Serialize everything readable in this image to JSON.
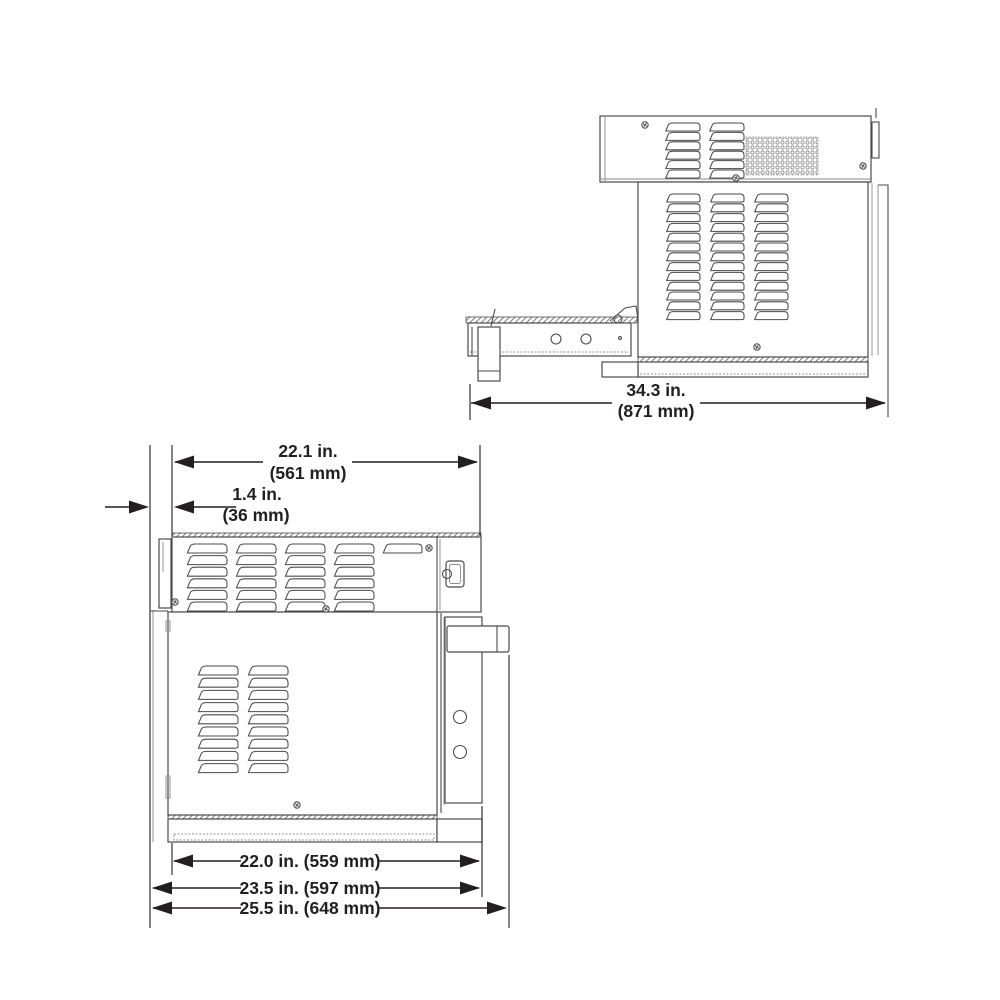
{
  "document": {
    "type": "technical-dimension-drawing",
    "views": [
      "side-view",
      "front-view"
    ]
  },
  "dims": {
    "depth": {
      "in_label": "34.3 in.",
      "mm_label": "(871 mm)"
    },
    "width_top": {
      "in_label": "22.1 in.",
      "mm_label": "(561 mm)"
    },
    "offset": {
      "in_label": "1.4 in.",
      "mm_label": "(36 mm)"
    },
    "width_inner": {
      "label": "22.0 in. (559 mm)"
    },
    "width_mid": {
      "label": "23.5 in. (597 mm)"
    },
    "width_outer": {
      "label": "25.5 in. (648 mm)"
    }
  },
  "colors": {
    "ink": "#231f20",
    "line": "#4b4b4b",
    "line_light": "#8a8a8a",
    "background": "#ffffff"
  }
}
